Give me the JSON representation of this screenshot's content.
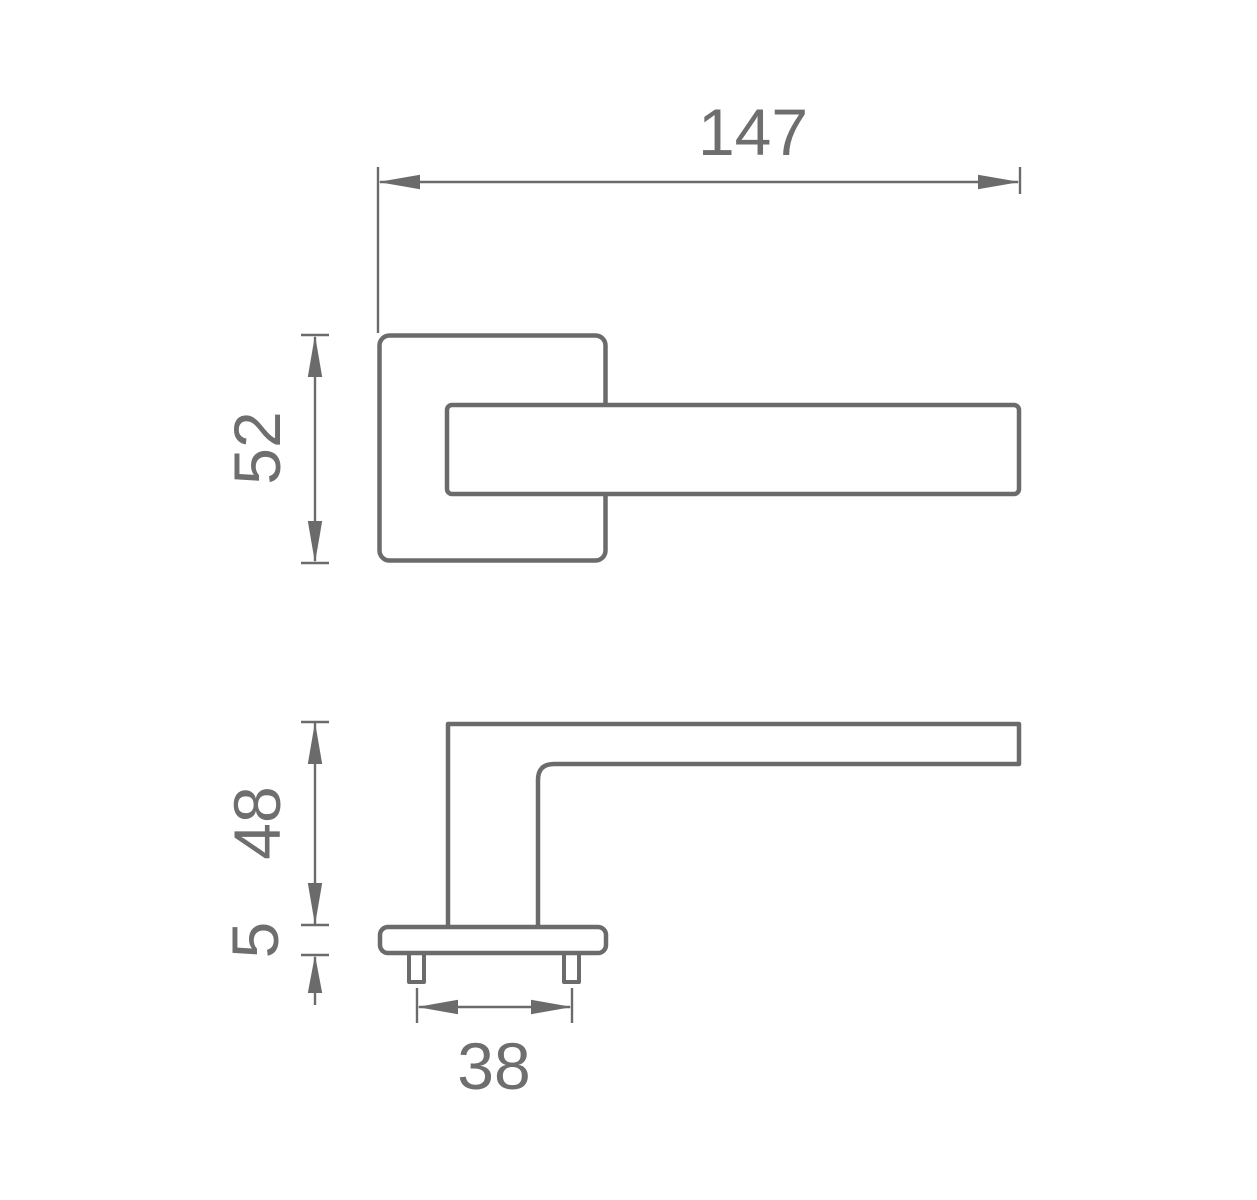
{
  "page": {
    "background": "#ffffff",
    "kind": "technical dimension drawing of a lever door handle on a square rosette, front view (top) and side profile view (bottom)"
  },
  "drawing": {
    "colors": {
      "line": "#6b6b6b",
      "text": "#6e6e6e"
    },
    "dimensions": {
      "handle_length": "147",
      "rosette_size": "52",
      "handle_height": "48",
      "rosette_thickness": "5",
      "fixing_spacing": "38"
    }
  }
}
